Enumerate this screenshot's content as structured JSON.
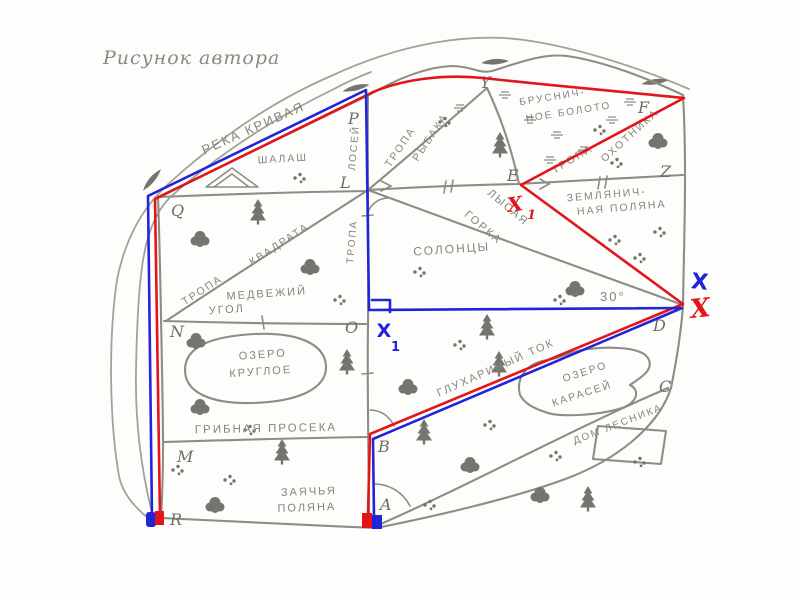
{
  "title": "Рисунок автора",
  "colors": {
    "route_red": "#e2151a",
    "route_blue": "#2224d8",
    "pencil_gray": "#8d8d85",
    "label_gray": "#84847c"
  },
  "labels": {
    "river": "РЕКА КРИВАЯ",
    "hut": "ШАЛАШ",
    "swamp1": "БРУСНИЧ-",
    "swamp2": "НОЕ БОЛОТО",
    "fisher1": "ТРОПА",
    "fisher2": "РЫБАКА",
    "hunter1": "ТРОПА",
    "hunter2": "ОХОТНИКА",
    "strawberry1": "ЗЕМЛЯНИЧ-",
    "strawberry2": "НАЯ ПОЛЯНА",
    "bald1": "ЛЫСАЯ",
    "bald2": "ГОРКА",
    "saltlick": "СОЛОНЦЫ",
    "square1": "ТРОПА",
    "square2": "КВАДРАТА",
    "moose_word1": "ЛОСЕЙ",
    "moose_word2": "ТРОПА",
    "bear1": "МЕДВЕЖИЙ",
    "bear2": "УГОЛ",
    "roundlake1": "ОЗЕРО",
    "roundlake2": "КРУГЛОЕ",
    "proseka": "ГРИБНАЯ ПРОСЕКА",
    "lek": "ГЛУХАРИНЫЙ ТОК",
    "carplake1": "ОЗЕРО",
    "carplake2": "КАРАСЕЙ",
    "house": "ДОМ ЛЕСНИКА",
    "hare1": "ЗАЯЧЬЯ",
    "hare2": "ПОЛЯНА"
  },
  "points": {
    "P": "P",
    "Q": "Q",
    "L": "L",
    "N": "N",
    "O": "O",
    "M": "M",
    "R": "R",
    "Y": "Y",
    "E": "E",
    "Z": "Z",
    "F": "F",
    "D": "D",
    "C": "C",
    "B": "B",
    "A": "A"
  },
  "annotations": {
    "angle": "30°",
    "blue_x": "X",
    "red_x": "X",
    "red_x1": "X",
    "red_x1_sub": "1",
    "blue_x1": "X",
    "blue_x1_sub": "1"
  }
}
